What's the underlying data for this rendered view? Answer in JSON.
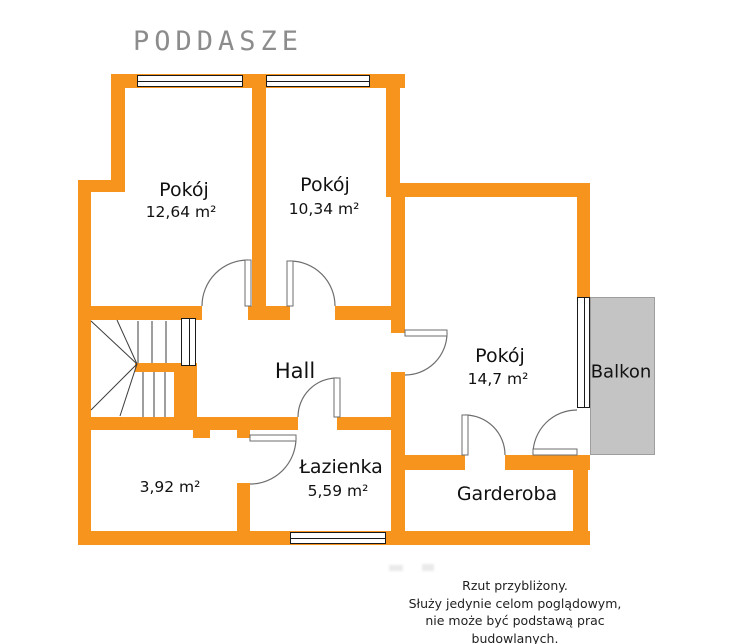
{
  "title": "PODDASZE",
  "rooms": {
    "pokoj1": {
      "name": "Pokój",
      "area": "12,64 m²"
    },
    "pokoj2": {
      "name": "Pokój",
      "area": "10,34 m²"
    },
    "pokoj3": {
      "name": "Pokój",
      "area": "14,7 m²"
    },
    "hall": {
      "name": "Hall"
    },
    "lazienka": {
      "name": "Łazienka",
      "area": "5,59 m²"
    },
    "garderoba": {
      "name": "Garderoba"
    },
    "storage": {
      "area": "3,92 m²"
    },
    "balkon": {
      "name": "Balkon"
    }
  },
  "disclaimer": {
    "line1": "Rzut przybliżony.",
    "line2": "Służy jedynie celom poglądowym,",
    "line3": "nie może być podstawą prac budowlanych."
  },
  "colors": {
    "wall": "#F7941E",
    "balcony": "#C4C4C4",
    "balcony_border": "#9E9E9E",
    "title_text": "#8C8C8C",
    "label_text": "#111111",
    "door_line": "#6E6E6E",
    "stair_line": "#3C3C3C",
    "window_border": "#1A1A1A",
    "disclaimer_text": "#1F1F1F"
  }
}
